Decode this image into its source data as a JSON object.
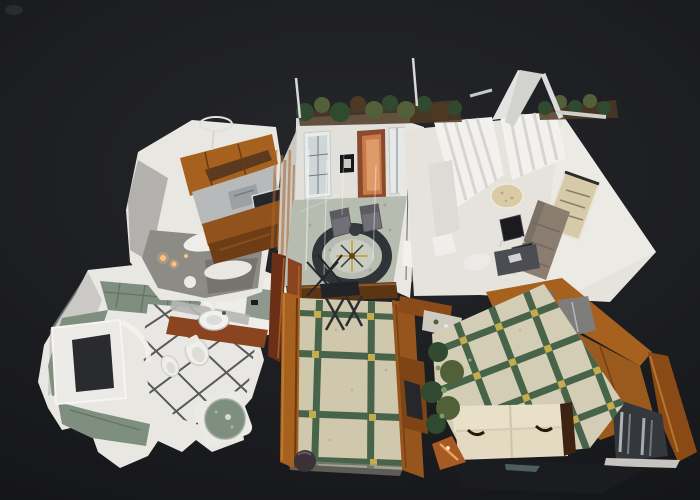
{
  "viewer": {
    "kind": "3d-dollhouse-floorplan-view",
    "background": "#1a1b1e"
  },
  "rooms": [
    {
      "id": "kitchen"
    },
    {
      "id": "entry-hall"
    },
    {
      "id": "living-room"
    },
    {
      "id": "bathroom"
    },
    {
      "id": "hallway"
    },
    {
      "id": "bedroom"
    }
  ],
  "colors": {
    "bg_top": "#26272b",
    "bg": "#1a1b1e",
    "bg_bottom": "#0f1013",
    "wall_white": "#e9e7e2",
    "wall_shadow": "#b3b1ad",
    "floor_light": "#e6e3dd",
    "gray_shadow": "#8d8b86",
    "gray_dark": "#76746f",
    "wood_amber": "#a6611f",
    "wood_dark": "#6e3a12",
    "wood_red": "#8a4420",
    "wood_light": "#c58035",
    "marble_beige": "#cfc8ad",
    "marble_green": "#47634a",
    "gold": "#c4ac4e",
    "tile_green": "#7e8e7f",
    "tile_green_dark": "#5c6c5e",
    "bath_floor": "#e8e7e3",
    "grout_dark": "#2a2a2e",
    "hall_floor": "#b7bcb1",
    "ring_dark": "#2f3439",
    "medallion": "#c9cdc3",
    "chair_gray": "#717076",
    "sofa_gray": "#8b7e71",
    "sofa_cream": "#e4dac2",
    "chair_black": "#1a1a1f",
    "curtain": "#f2f1ee",
    "curtain_shadow": "#d7d5d1",
    "art_beige": "#d7caa9",
    "plant_green": "#2f4a2e",
    "plant_olive": "#52603a",
    "plant_brown": "#4e3a24",
    "door_orange": "#c97a4a",
    "door_orange_dark": "#8a4a2e",
    "glass_gray": "#6f7478",
    "steel": "#9aa0a3",
    "cooktop": "#23262b",
    "glow": "#ffc07a",
    "white_artifact": "#dcdcda",
    "shadow_mass": "#1b1c1f"
  }
}
